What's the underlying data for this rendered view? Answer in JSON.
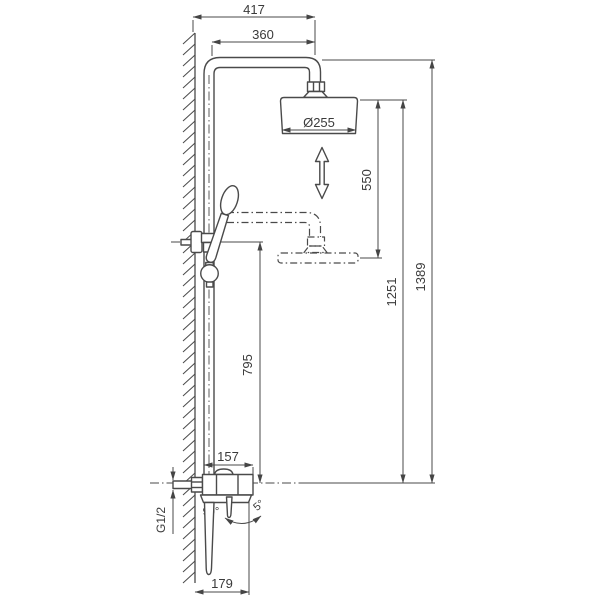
{
  "dims": {
    "d417": "417",
    "d360": "360",
    "head_dia": "Ø255",
    "d550": "550",
    "d1251": "1251",
    "d1389": "1389",
    "d795": "795",
    "d157": "157",
    "d179": "179",
    "angle_handle": "90°",
    "angle_lever": "5°",
    "thread": "G1/2"
  },
  "colors": {
    "line": "#4a4a4a",
    "text": "#3a3a3a",
    "background": "#ffffff"
  }
}
